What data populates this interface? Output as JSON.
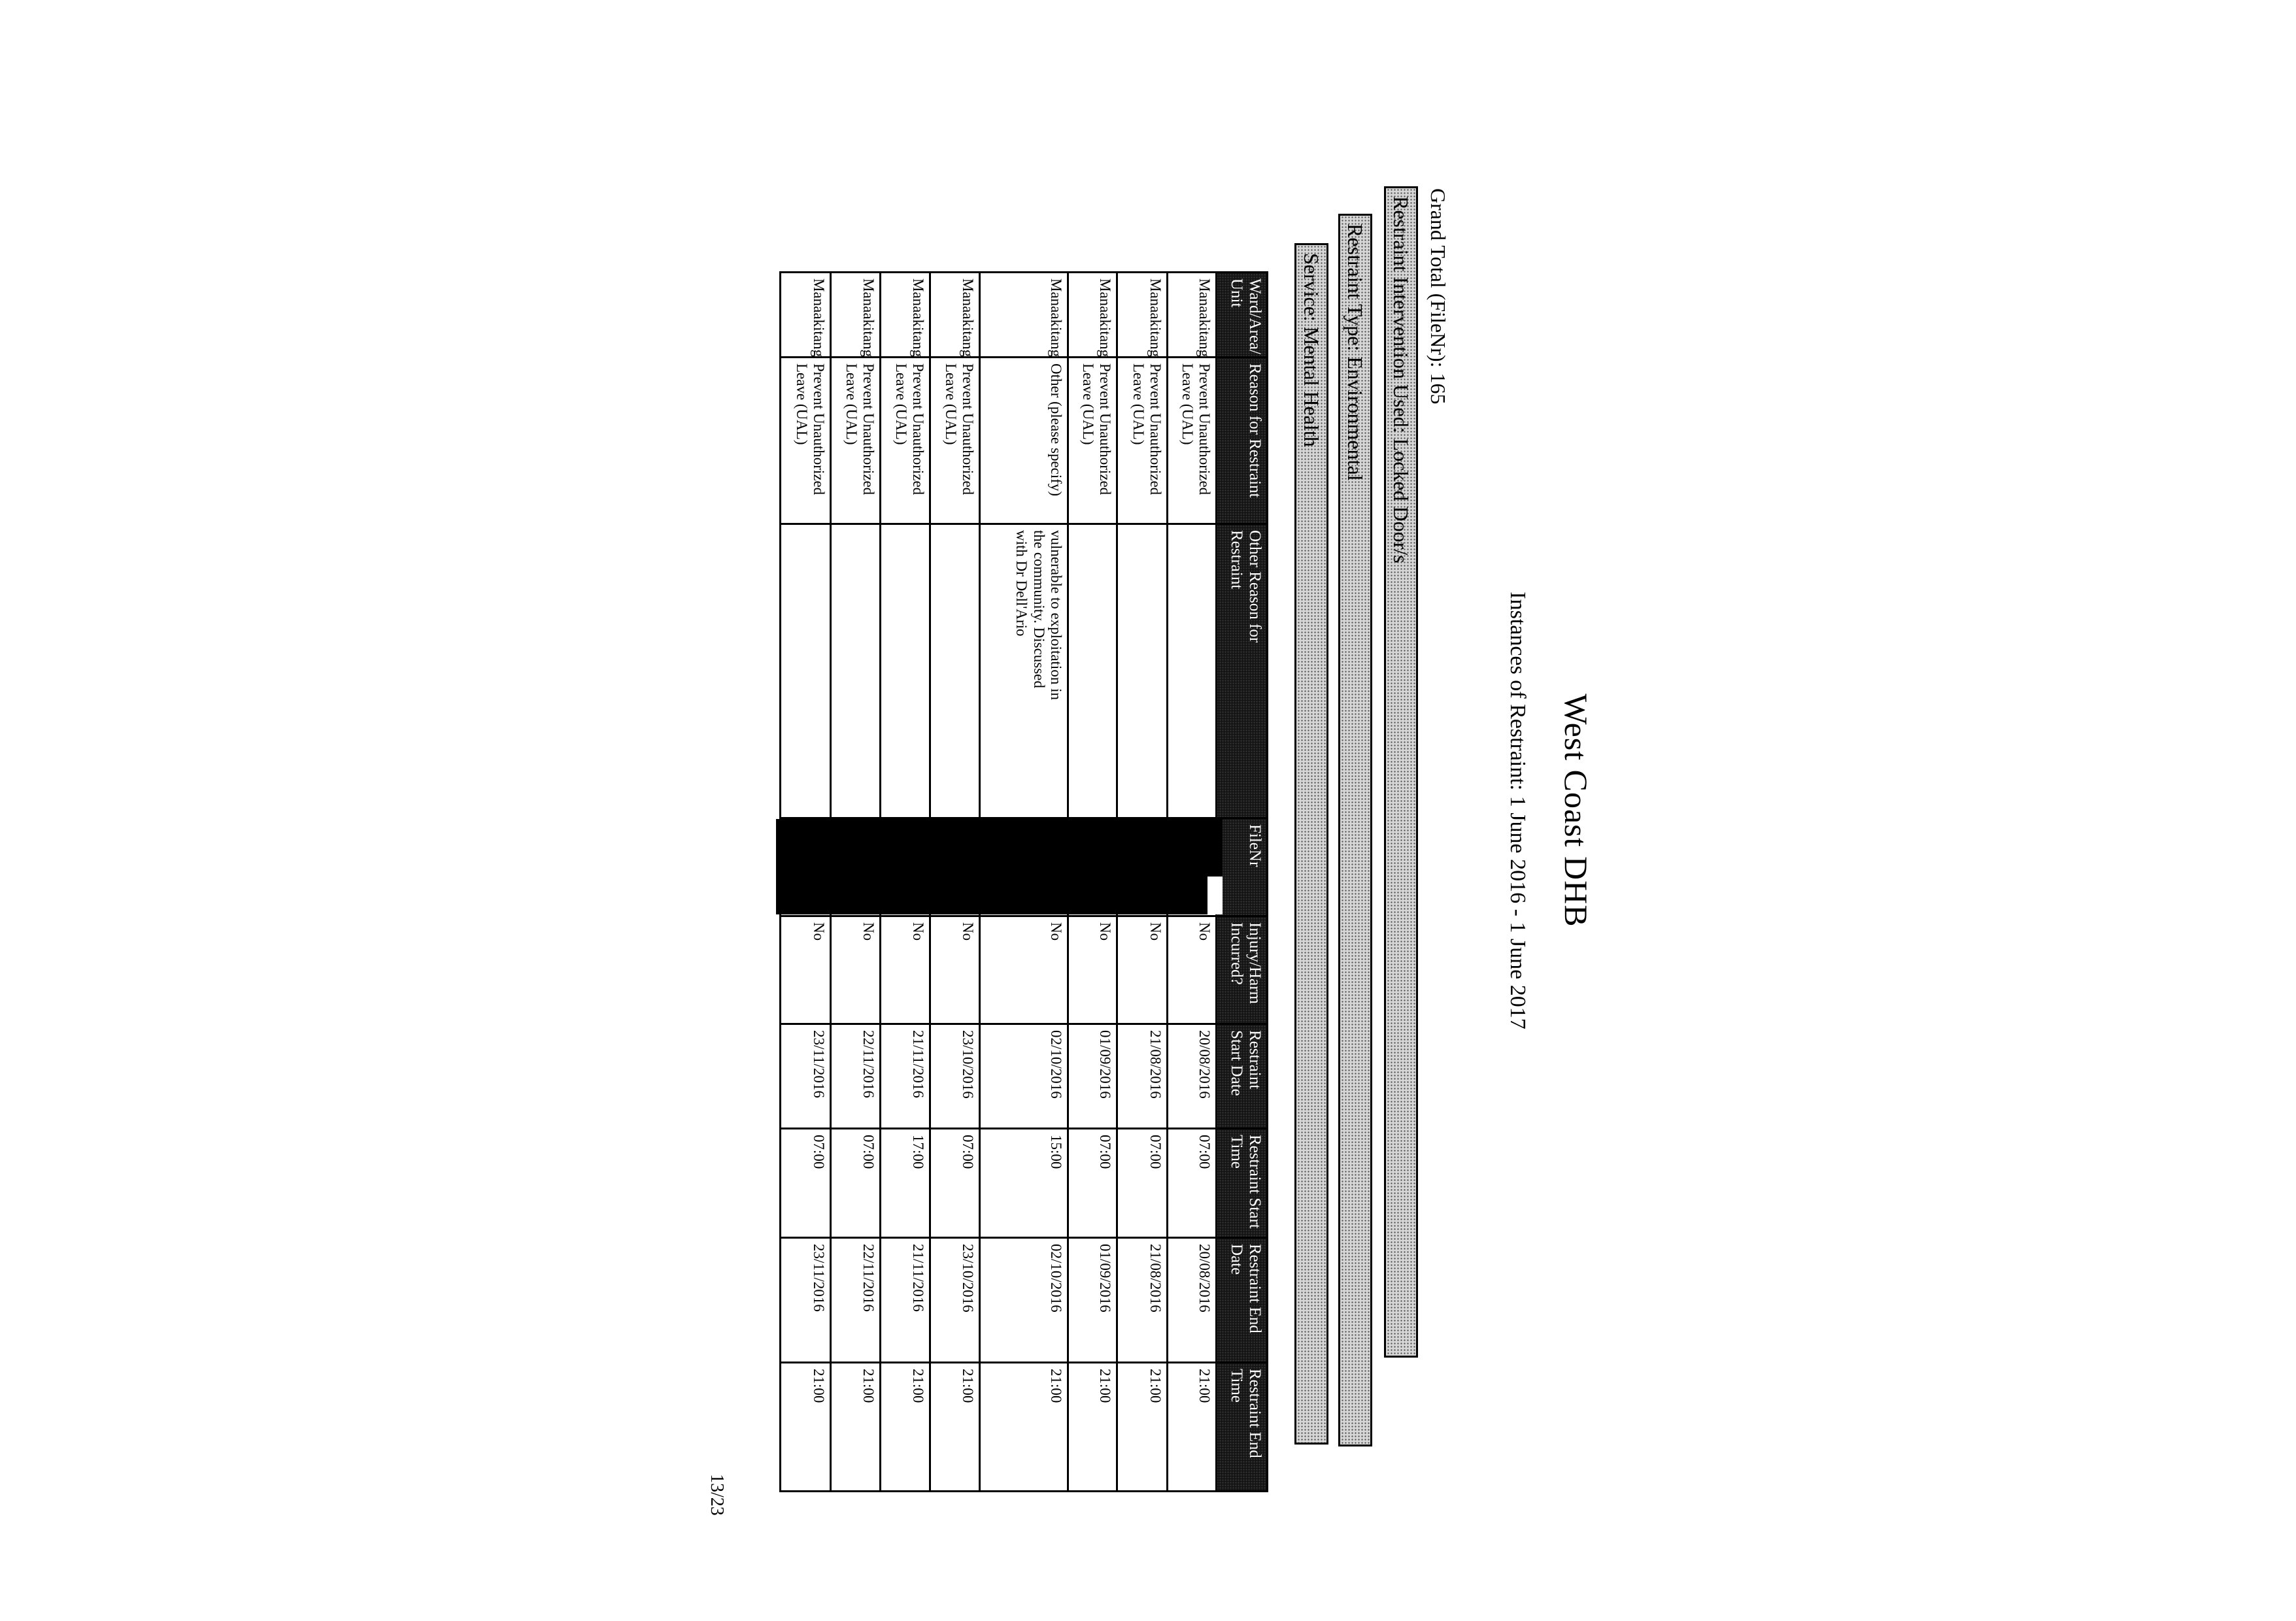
{
  "page": {
    "title": "West Coast DHB",
    "subtitle": "Instances of Restraint: 1 June 2016 -  1 June 2017",
    "grand_total_line": "Grand Total (FileNr): 165",
    "page_number": "13/23"
  },
  "section_bars": {
    "intervention": "Restraint Intervention Used: Locked Door/s",
    "type": "Restraint Type: Environmental",
    "service": "Service: Mental Health"
  },
  "table": {
    "headers": [
      "Ward/Area/ Unit",
      "Reason for Restraint",
      "Other Reason for Restraint",
      "FileNr",
      "Injury/Harm Incurred?",
      "Restraint Start Date",
      "Restraint Start Time",
      "Restraint End Date",
      "Restraint End Time"
    ],
    "redaction_color": "#000000",
    "rows": [
      {
        "ward": "Manaakitanga",
        "reason": "Prevent Unauthorized Leave (UAL)",
        "other_reason": "",
        "filenr": "",
        "injury": "No",
        "start_date": "20/08/2016",
        "start_time": "07:00",
        "end_date": "20/08/2016",
        "end_time": "21:00"
      },
      {
        "ward": "Manaakitanga",
        "reason": "Prevent Unauthorized Leave (UAL)",
        "other_reason": "",
        "filenr": "",
        "injury": "No",
        "start_date": "21/08/2016",
        "start_time": "07:00",
        "end_date": "21/08/2016",
        "end_time": "21:00"
      },
      {
        "ward": "Manaakitanga",
        "reason": "Prevent Unauthorized Leave (UAL)",
        "other_reason": "",
        "filenr": "",
        "injury": "No",
        "start_date": "01/09/2016",
        "start_time": "07:00",
        "end_date": "01/09/2016",
        "end_time": "21:00"
      },
      {
        "ward": "Manaakitanga",
        "reason": "Other (please specify)",
        "other_reason": "vulnerable to exploitation in the community. Discussed with Dr Dell'Ario",
        "filenr": "",
        "injury": "No",
        "start_date": "02/10/2016",
        "start_time": "15:00",
        "end_date": "02/10/2016",
        "end_time": "21:00"
      },
      {
        "ward": "Manaakitanga",
        "reason": "Prevent Unauthorized Leave (UAL)",
        "other_reason": "",
        "filenr": "",
        "injury": "No",
        "start_date": "23/10/2016",
        "start_time": "07:00",
        "end_date": "23/10/2016",
        "end_time": "21:00"
      },
      {
        "ward": "Manaakitanga",
        "reason": "Prevent Unauthorized Leave (UAL)",
        "other_reason": "",
        "filenr": "",
        "injury": "No",
        "start_date": "21/11/2016",
        "start_time": "17:00",
        "end_date": "21/11/2016",
        "end_time": "21:00"
      },
      {
        "ward": "Manaakitanga",
        "reason": "Prevent Unauthorized Leave (UAL)",
        "other_reason": "",
        "filenr": "",
        "injury": "No",
        "start_date": "22/11/2016",
        "start_time": "07:00",
        "end_date": "22/11/2016",
        "end_time": "21:00"
      },
      {
        "ward": "Manaakitanga",
        "reason": "Prevent Unauthorized Leave (UAL)",
        "other_reason": "",
        "filenr": "",
        "injury": "No",
        "start_date": "23/11/2016",
        "start_time": "07:00",
        "end_date": "23/11/2016",
        "end_time": "21:00"
      }
    ]
  }
}
